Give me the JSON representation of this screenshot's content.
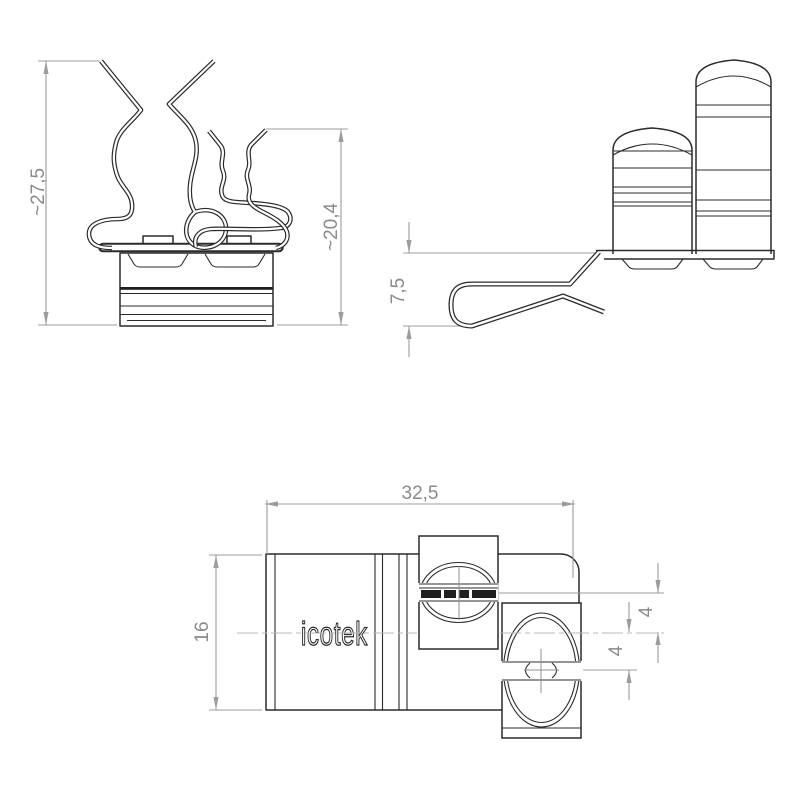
{
  "drawing": {
    "brand_label": "icotek",
    "views": {
      "front": {
        "dimensions": {
          "total_height": "~27,5",
          "rear_spring_height": "~20,4"
        }
      },
      "side": {
        "dimensions": {
          "foot_drop": "7,5"
        }
      },
      "top": {
        "dimensions": {
          "width": "32,5",
          "depth": "16",
          "upper_spring_offset": "4",
          "lower_spring_offset": "4"
        }
      }
    },
    "colors": {
      "background": "#ffffff",
      "object_line": "#2b2b2b",
      "dimension_line": "#9c9c9c",
      "dimension_text": "#8a8a8a",
      "centerline": "#b8b8b8"
    }
  }
}
